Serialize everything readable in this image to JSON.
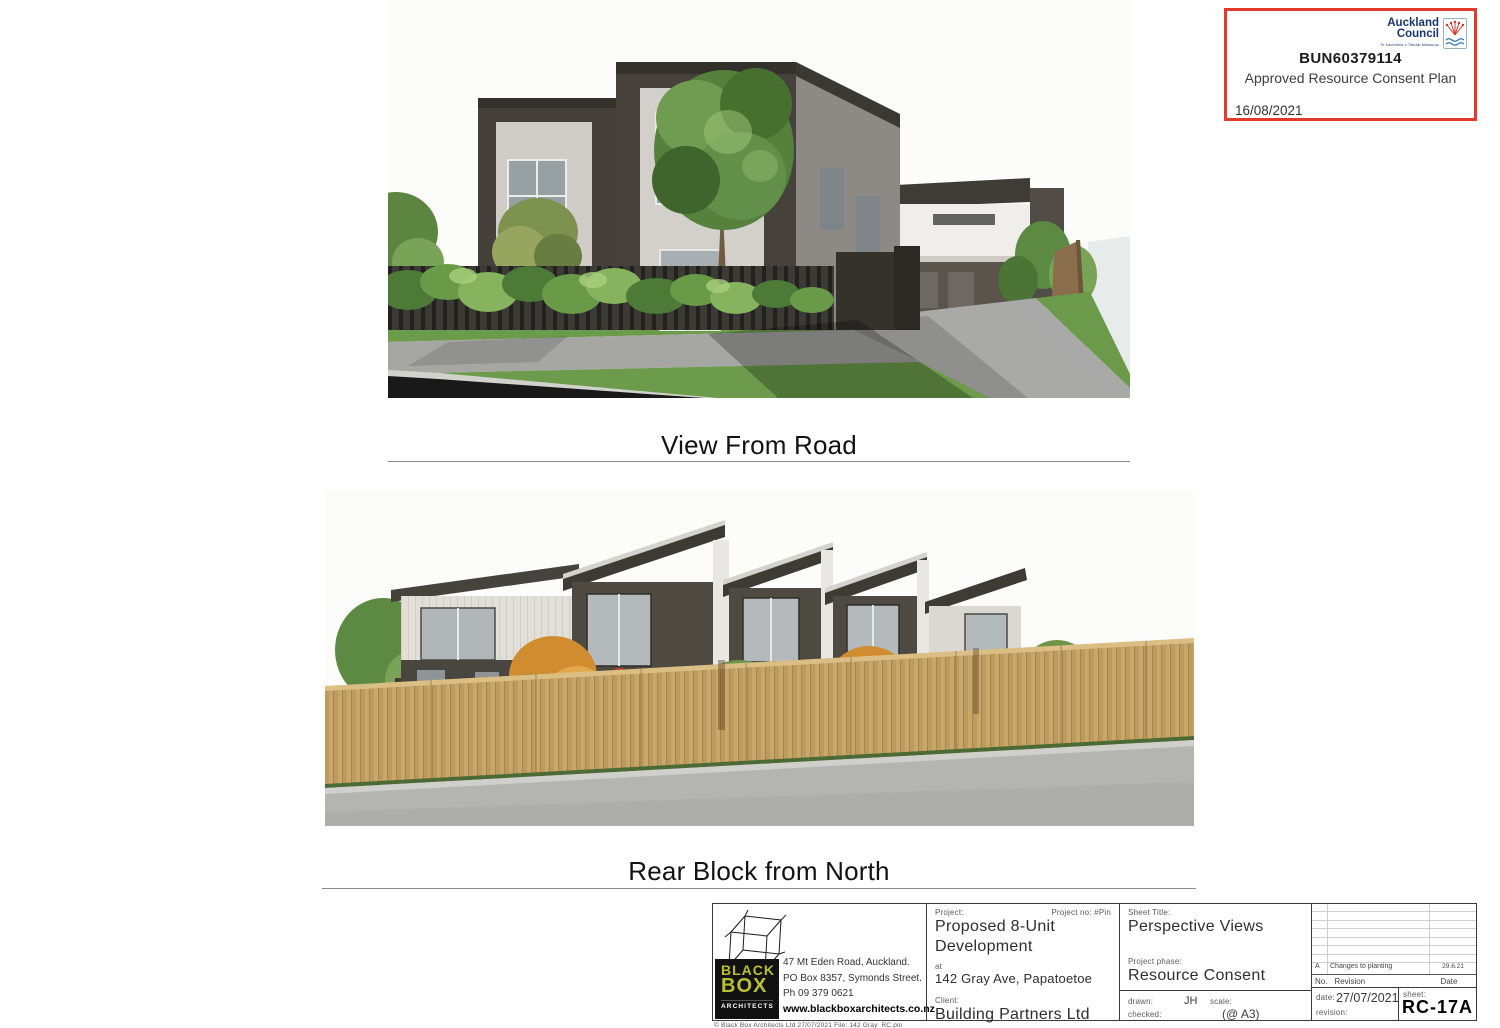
{
  "stamp": {
    "border_color": "#e23b2e",
    "logo": {
      "line1": "Auckland",
      "line2": "Council",
      "tagline": "Te Kaunihera o Tāmaki Makaurau"
    },
    "reference": "BUN60379114",
    "approval_text": "Approved Resource Consent Plan",
    "approval_date": "16/08/2021"
  },
  "sections": {
    "top_view_caption": "View From Road",
    "bottom_view_caption": "Rear Block from North"
  },
  "title_block": {
    "architect": {
      "logo_word1": "BLACK",
      "logo_word2": "BOX",
      "logo_word3": "ARCHITECTS",
      "logo_accent_color": "#b9bf33",
      "address_line1": "47 Mt Eden Road, Auckland.",
      "address_line2": "PO Box 8357, Symonds Street.",
      "phone": "Ph 09 379 0621",
      "website": "www.blackboxarchitects.co.nz",
      "copyright": "© Black Box Architects Ltd 27/07/2021  File: 142 Gray_RC.pln"
    },
    "project": {
      "project_label": "Project:",
      "project_no_label": "Project no: #Pin",
      "name_line1": "Proposed 8-Unit",
      "name_line2": "Development",
      "at_label": "at",
      "site_address": "142 Gray Ave, Papatoetoe",
      "client_label": "Client:",
      "client_name": "Building Partners Ltd"
    },
    "sheet": {
      "sheet_title_label": "Sheet Title:",
      "sheet_title": "Perspective Views",
      "phase_label": "Project phase:",
      "phase": "Resource Consent",
      "drawn_label": "drawn:",
      "drawn_by": "JH",
      "scale_label": "scale:",
      "scale_value": "(@ A3)",
      "checked_label": "checked:",
      "date_label": "date:",
      "date_value": "27/07/2021",
      "revision_label": "revision:",
      "sheet_no_label": "sheet:",
      "sheet_no": "RC-17A"
    },
    "revision_table": {
      "header_no": "No.",
      "header_revision": "Revision",
      "header_date": "Date",
      "rows": [
        {
          "no": "A",
          "description": "Changes to planting",
          "date": "29.6.21"
        }
      ]
    }
  },
  "renders": {
    "top": {
      "name": "view-from-road-render",
      "palette": {
        "cladding_dark": "#46423b",
        "cladding_light": "#d3d0cb",
        "door_accent": "#c85a1d",
        "lawn": "#6b9b4b",
        "paving": "#a6a6a3",
        "road": "#191919"
      }
    },
    "bottom": {
      "name": "rear-block-render",
      "palette": {
        "cladding_dark": "#4e4a42",
        "cladding_light": "#e1dfd7",
        "fence_timber": "#c9a66a",
        "wall_concrete": "#b4b4b2",
        "shrub_orange": "#d08c2f",
        "shrub_green": "#6d9448"
      }
    }
  }
}
